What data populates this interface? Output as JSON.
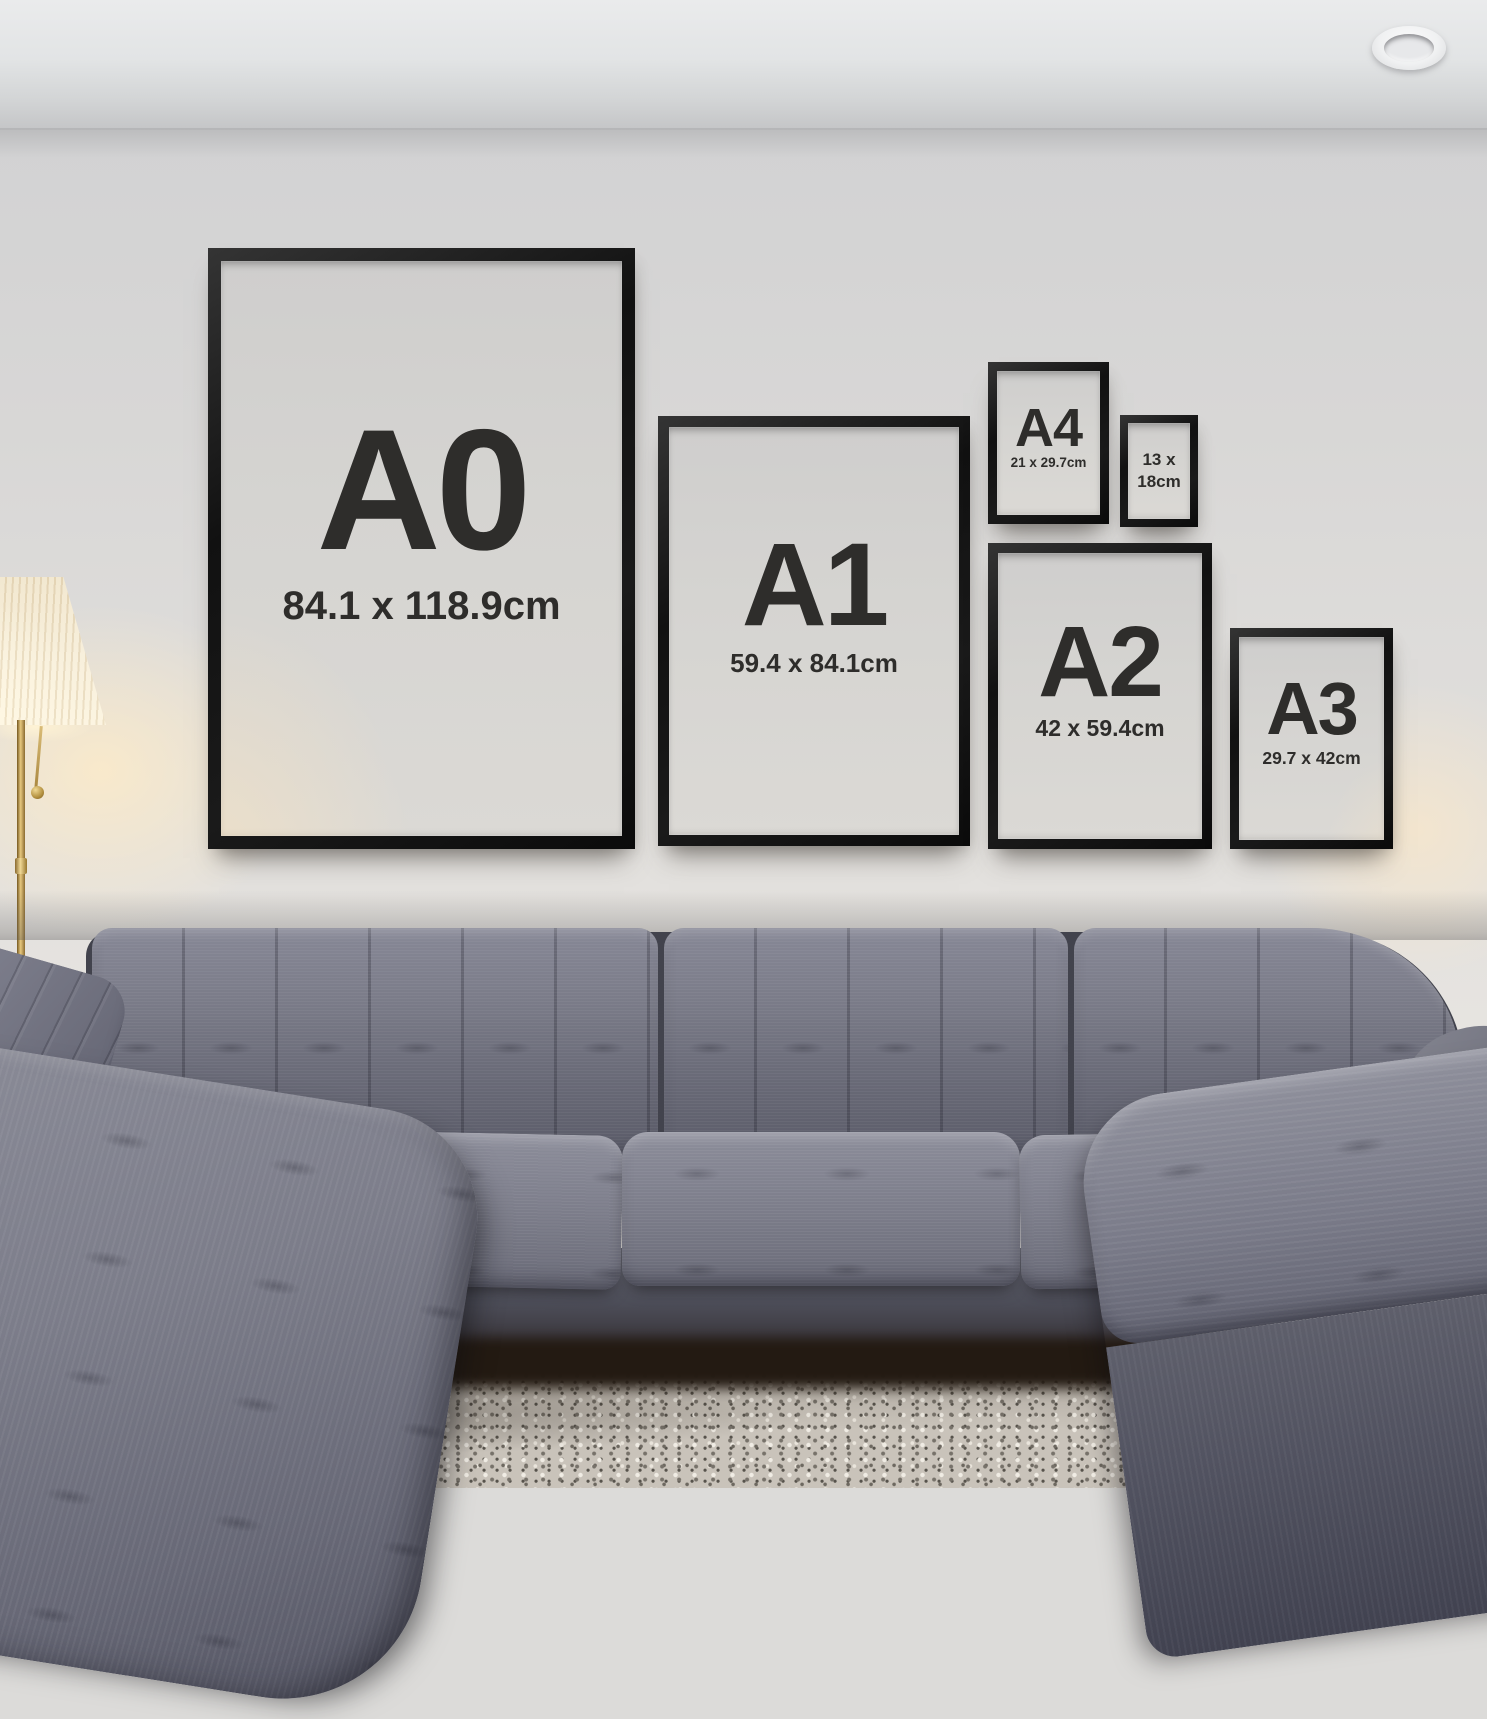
{
  "frames": [
    {
      "id": "A0",
      "label": "A0",
      "dimensions": "84.1 x 118.9cm"
    },
    {
      "id": "A1",
      "label": "A1",
      "dimensions": "59.4 x 84.1cm"
    },
    {
      "id": "A4",
      "label": "A4",
      "dimensions": "21 x 29.7cm"
    },
    {
      "id": "13x18",
      "dimensions_line1": "13 x",
      "dimensions_line2": "18cm"
    },
    {
      "id": "A2",
      "label": "A2",
      "dimensions": "42 x 59.4cm"
    },
    {
      "id": "A3",
      "label": "A3",
      "dimensions": "29.7 x 42cm"
    }
  ],
  "colors": {
    "frame": "#141414",
    "poster_background": "#d5d4d1",
    "poster_text": "#2e2d2b",
    "wall": "#dcdbd9",
    "ceiling": "#e2e4e5",
    "sofa_fabric": "#6e6f7d",
    "sofa_shadow": "#42434d",
    "rug": "#c9c3ba",
    "lamp_shade": "#f6edd8",
    "lamp_brass": "#b8913f",
    "under_sofa": "#231a12"
  }
}
